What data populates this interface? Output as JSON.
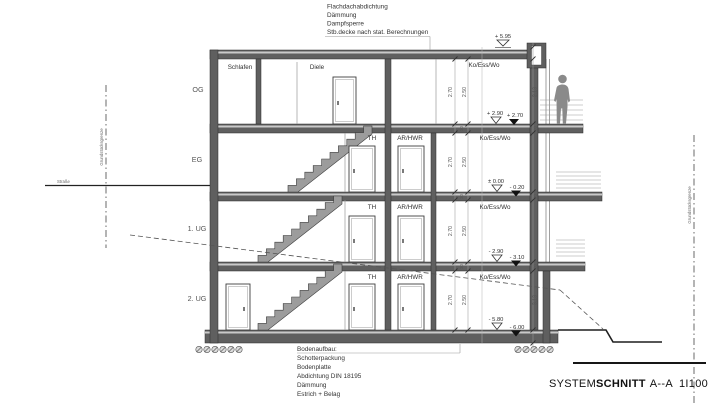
{
  "drawing": {
    "colors": {
      "wall": "#5f5f5f",
      "stair": "#9c9c9c",
      "person": "#8a8a8a",
      "line": "#3a3a3a"
    },
    "title": {
      "normal": "SYSTEM",
      "bold": "SCHNITT",
      "section": "A--A",
      "scale": "1I100"
    },
    "roof_note": {
      "lines": [
        "Flachdachabdichtung",
        "Dämmung",
        "Dampfsperre",
        "Stb.decke nach stat. Berechnungen"
      ]
    },
    "floor_note": {
      "lines": [
        "Bodenaufbau:",
        "Schotterpackung",
        "Bodenplatte",
        "Abdichtung DIN 18195",
        "Dämmung",
        "Estrich + Belag"
      ]
    },
    "floors": [
      {
        "label": "OG",
        "rooms": [
          "Schlafen",
          "Diele",
          "Ko/Ess/Wo"
        ]
      },
      {
        "label": "EG",
        "rooms": [
          "TH",
          "AR/HWR",
          "Ko/Ess/Wo"
        ]
      },
      {
        "label": "1. UG",
        "rooms": [
          "TH",
          "AR/HWR",
          "Ko/Ess/Wo"
        ]
      },
      {
        "label": "2. UG",
        "rooms": [
          "TH",
          "AR/HWR",
          "Ko/Ess/Wo"
        ]
      }
    ],
    "levels": {
      "roof": "+ 5.95",
      "og_raw": "+ 2.90",
      "og_fin": "+ 2.70",
      "eg_raw": "± 0.00",
      "eg_fin": "- 0.20",
      "ug1_raw": "- 2.90",
      "ug1_fin": "- 3.10",
      "ug2_raw": "- 5.80",
      "ug2_fin": "- 6.00"
    },
    "dims": {
      "storey_a": "2.70",
      "storey_b": "2.50",
      "slab": "20",
      "right_og": "2.13",
      "right_ug2": "3.13"
    },
    "site": {
      "boundary_left": "Grundstücksgrenze",
      "boundary_right": "Grundstücksgrenze",
      "street": "Straße"
    }
  }
}
